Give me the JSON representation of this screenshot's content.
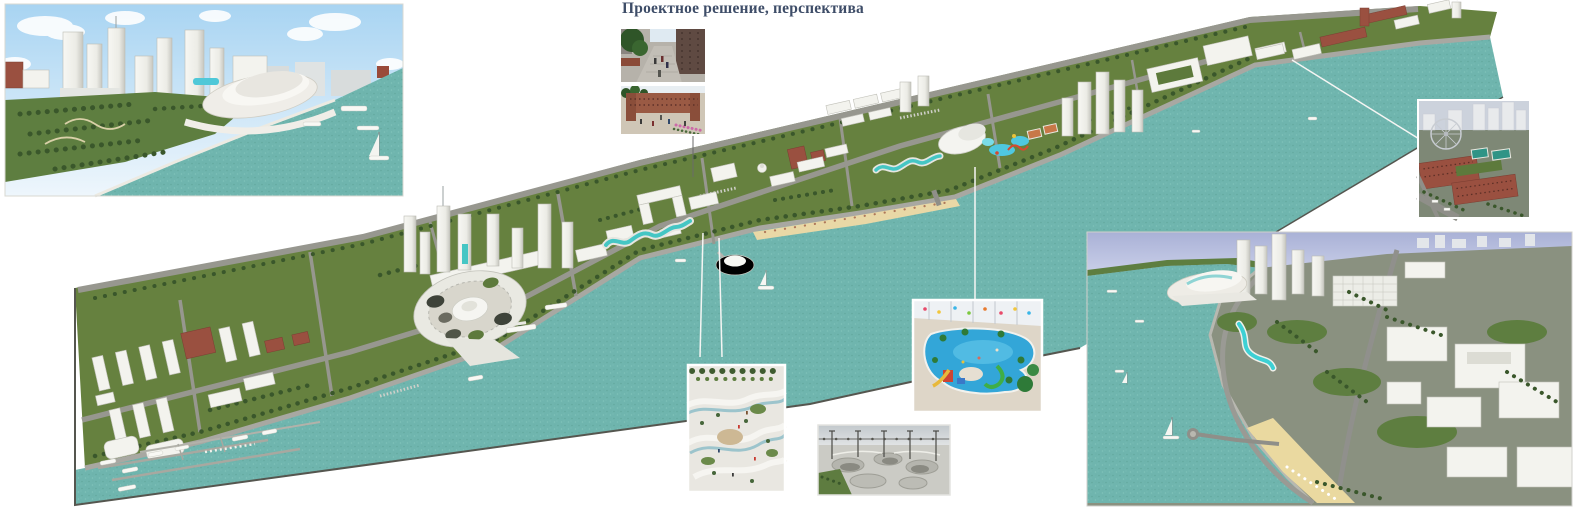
{
  "title": {
    "text": "Проектное решение, перспектива",
    "color": "#3e4d68"
  },
  "palette": {
    "water_teal": "#6fb5ae",
    "land_green": "#66813f",
    "road_gray": "#97978f",
    "building_white": "#f3f3ee",
    "brick_red": "#9a5040",
    "sand_beach": "#e9d8a6",
    "accent_cyan": "#45c6c4",
    "sky_blue": "#a8d4f2",
    "sky_periwinkle": "#a9b1d6",
    "title_color": "#3e4d68"
  },
  "panels": [
    {
      "id": "hero-render-top-left"
    },
    {
      "id": "main-panorama"
    },
    {
      "id": "inset-street-view"
    },
    {
      "id": "inset-brick-courtyard"
    },
    {
      "id": "inset-aquapark"
    },
    {
      "id": "inset-landscape-playground"
    },
    {
      "id": "inset-skatepark"
    },
    {
      "id": "inset-brick-quarter-aerial"
    },
    {
      "id": "hero-render-bottom-right"
    }
  ]
}
